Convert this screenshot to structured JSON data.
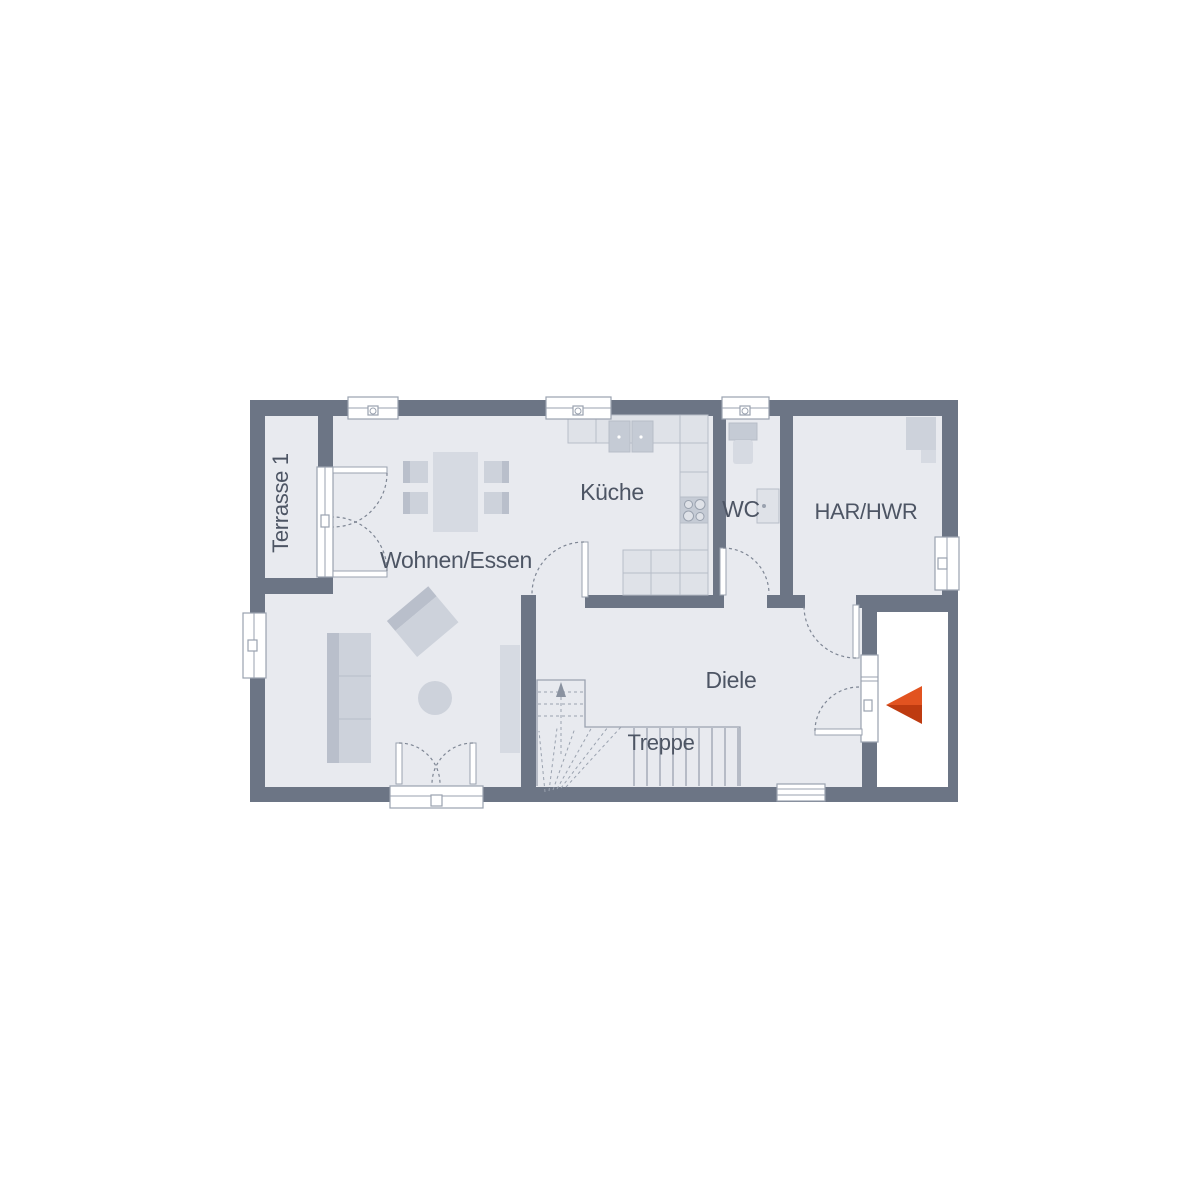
{
  "plan": {
    "title": "Erdgeschoss Grundriss",
    "rooms": {
      "terrasse": {
        "label": "Terrasse 1"
      },
      "wohnen_essen": {
        "label": "Wohnen/Essen"
      },
      "kueche": {
        "label": "Küche"
      },
      "wc": {
        "label": "WC"
      },
      "har_hwr": {
        "label": "HAR/HWR"
      },
      "diele": {
        "label": "Diele"
      },
      "treppe": {
        "label": "Treppe"
      }
    },
    "colors": {
      "wall": "#6C7585",
      "floor": "#E8EAEF",
      "white": "#FFFFFF",
      "furniture": "#CDD2DB",
      "furniture_dark": "#B9BFCB",
      "furniture_light": "#D6DAE2",
      "counter": "#DFE2E8",
      "counter_dark": "#C5CBD5",
      "line": "#9AA2AF",
      "grid": "#B7BDC8",
      "dash": "#7E8694",
      "stair": "#9AA2AF",
      "label": "#4D5564",
      "arrow_light": "#E25320",
      "arrow_dark": "#BE3B10"
    }
  }
}
